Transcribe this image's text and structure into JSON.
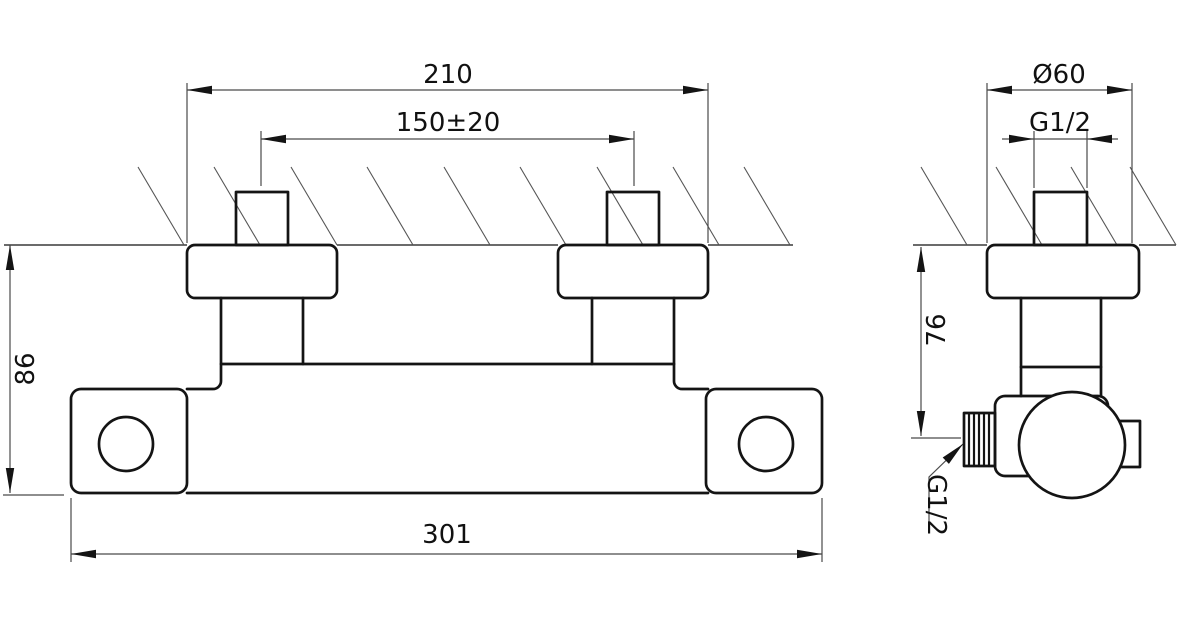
{
  "drawing": {
    "kind": "technical dimension drawing - wall-mounted thermostatic shower mixer, front and side views",
    "views": {
      "front": {
        "dims": {
          "escutcheon_span": "210",
          "inlet_centers": "150±20",
          "body_height": "86",
          "body_length": "301"
        }
      },
      "side": {
        "dims": {
          "escutcheon_diameter": "Ø60",
          "inlet_thread": "G1/2",
          "outlet_drop": "76",
          "outlet_thread": "G1/2"
        }
      }
    },
    "colors": {
      "object_line": "#141414",
      "thin_line": "#4a4a4a",
      "background": "#ffffff"
    }
  }
}
